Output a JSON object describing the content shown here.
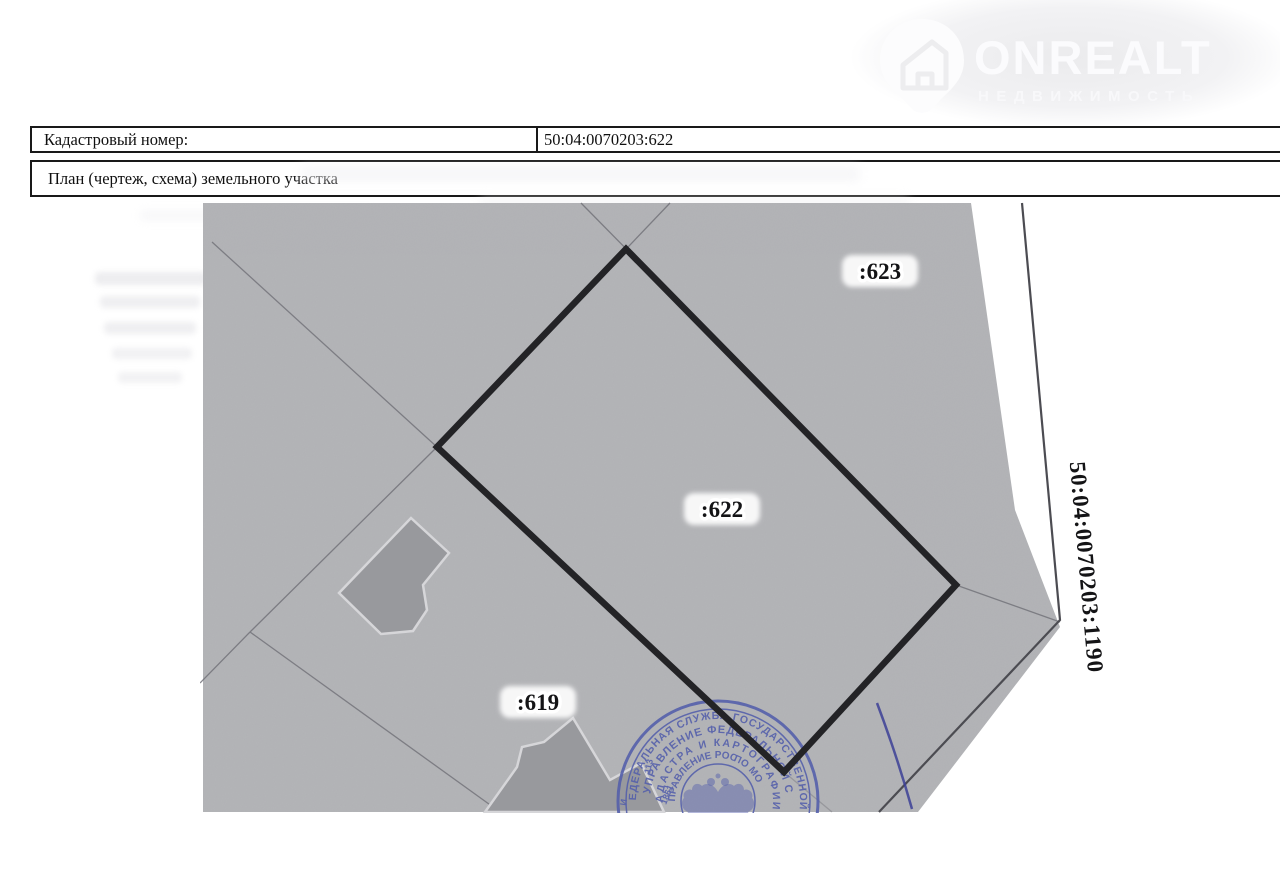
{
  "header": {
    "logo": {
      "brand": "ONREALT",
      "subtitle": "НЕДВИЖИМОСТЬ"
    }
  },
  "table": {
    "row1": {
      "label": "Кадастровый номер:",
      "value": "50:04:0070203:622"
    },
    "row2": {
      "label": "План (чертеж, схема) земельного участка"
    }
  },
  "map": {
    "parcels": {
      "p623": ":623",
      "p622": ":622",
      "p619": ":619"
    },
    "boundary_label": "50:04:0070203:1190",
    "stamp": {
      "ring1": "ФЕДЕРАЛЬНАЯ СЛУЖБА ГОСУДАРСТВЕННОЙ",
      "ring2": "УПРАВЛЕНИЕ ФЕДЕРАЛЬНОЙ С",
      "ring3": "КАДАСТРА И КАРТОГРАФИИ",
      "ring4_left": "(УПРАВЛЕНИЕ РОС",
      "ring4_right": "ПО МО",
      "side_number": "113",
      "side_year": "1861",
      "side_letter": "И"
    },
    "colors": {
      "map_bg": "#b4b5b8",
      "building": "#98999d",
      "building_halo": "#d6d6d9",
      "parcel_outline": "#232326",
      "thin_line": "#73737a",
      "boundary_line": "#4c4c52",
      "label_ink": "#141416",
      "label_halo": "#ffffff",
      "stamp_blue": "#5560ab",
      "pen_blue": "#3c3f97"
    }
  }
}
